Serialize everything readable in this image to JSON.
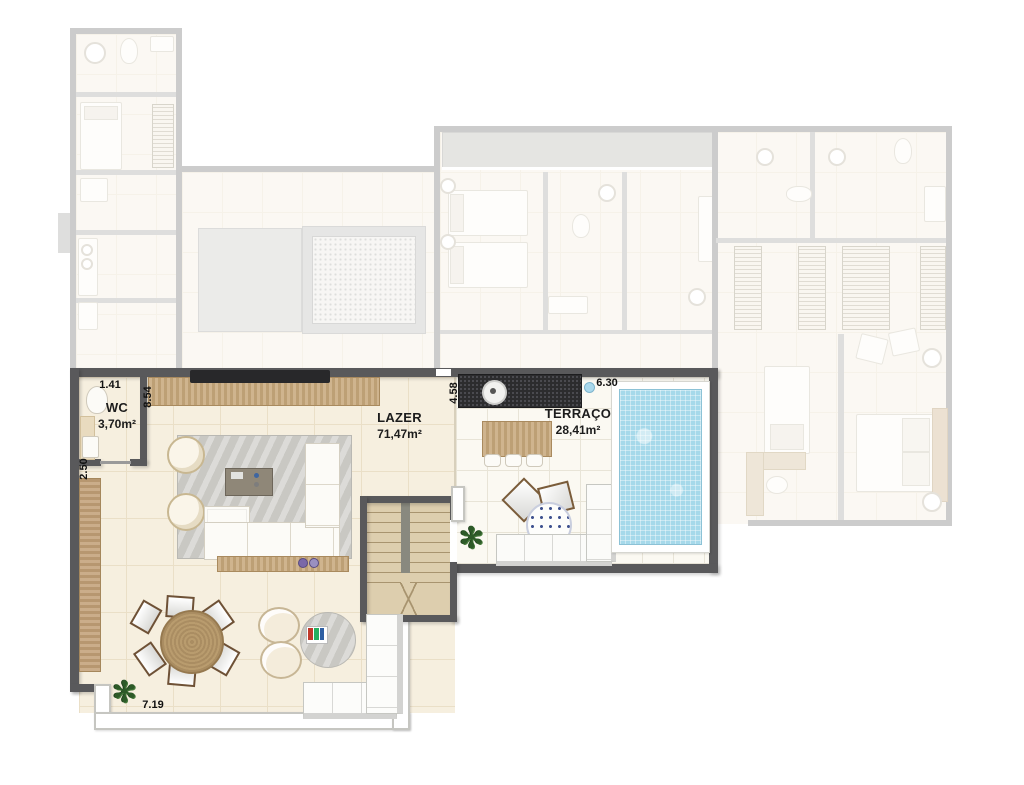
{
  "plan": {
    "rooms": [
      {
        "id": "wc",
        "name": "WC",
        "area": "3,70m²"
      },
      {
        "id": "lazer",
        "name": "LAZER",
        "area": "71,47m²"
      },
      {
        "id": "terraco",
        "name": "TERRAÇO",
        "area": "28,41m²"
      }
    ],
    "dimensions": [
      {
        "id": "wc-width",
        "value": "1.41"
      },
      {
        "id": "living-top",
        "value": "8.54"
      },
      {
        "id": "wc-depth",
        "value": "2.50"
      },
      {
        "id": "living-terrace",
        "value": "4.58"
      },
      {
        "id": "terrace-width",
        "value": "6.30"
      },
      {
        "id": "balcony-width",
        "value": "7.19"
      }
    ],
    "colors": {
      "active_wall": "#59595b",
      "active_floor": "#f6efdf",
      "terrace_floor": "#fbf9f2",
      "wood": "#c7a87b",
      "rug": "#c9c8c3",
      "pool_water": "#a6d9ea",
      "bar_counter": "#2c2c2e",
      "plant_green": "#2d5a28",
      "railing": "#ffffff",
      "faded_wall": "#a3a3a3"
    }
  }
}
